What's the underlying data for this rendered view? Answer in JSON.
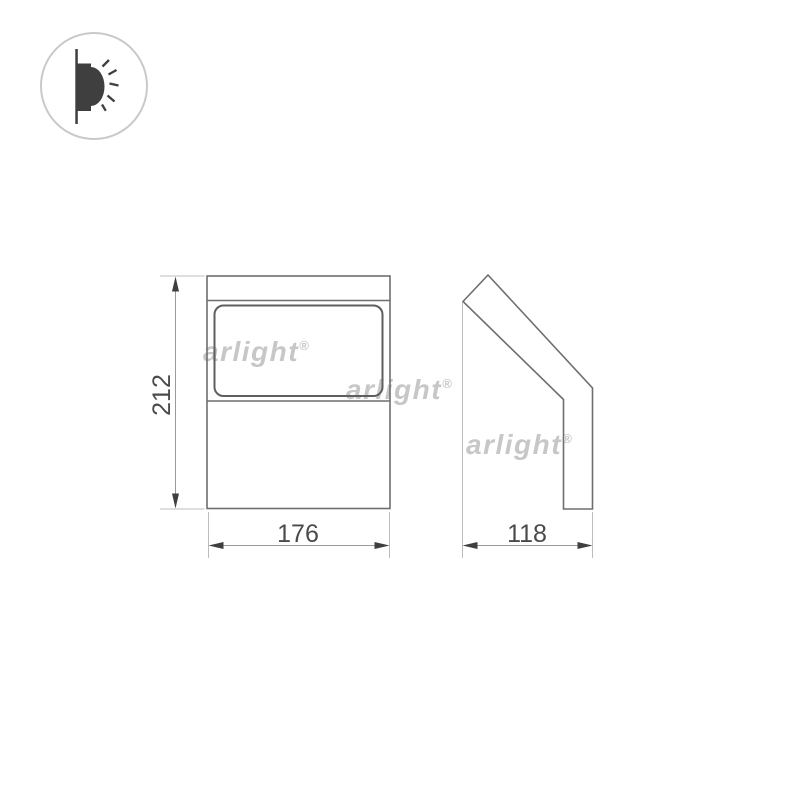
{
  "drawing": {
    "title_icon": "wall-mounted-light-emission-icon",
    "views": {
      "front": {
        "height_label": "212",
        "width_label": "176"
      },
      "side": {
        "depth_label": "118"
      }
    },
    "watermarks": [
      {
        "text": "arlight",
        "reg": "®"
      },
      {
        "text": "arlight",
        "reg": "®"
      },
      {
        "text": "arlight",
        "reg": "®"
      }
    ]
  },
  "colors": {
    "background": "#ffffff",
    "outline": "#6e6e6e",
    "lens_outline": "#5f5f5f",
    "extension_line": "#bdbdbd",
    "dimension_line": "#9a9a9a",
    "arrow": "#3f3f3f",
    "dimension_text": "#4a4a4a",
    "watermark": "#c7c7c7",
    "icon_dark": "#3f3f3f",
    "icon_circle": "#c9c9c9"
  }
}
